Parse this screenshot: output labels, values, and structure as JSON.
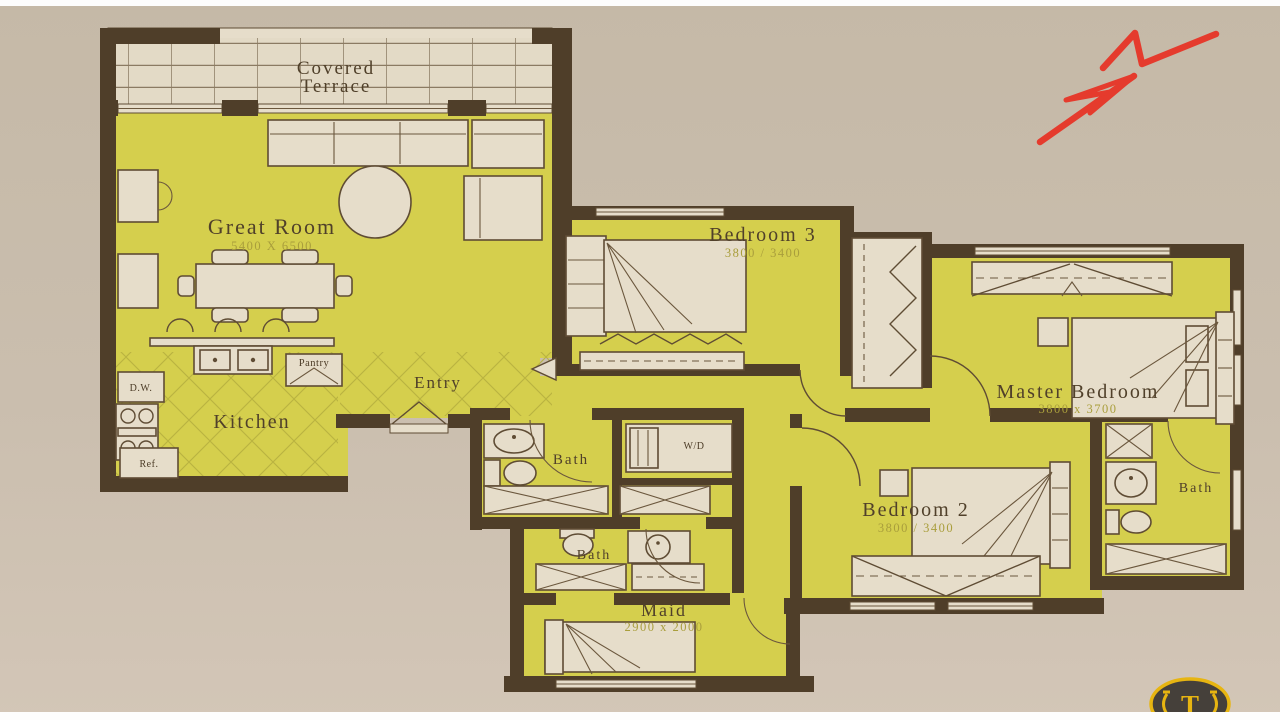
{
  "colors": {
    "paper": "#c8bcab",
    "paper_bottom": "#d2c5b6",
    "room_highlight": "#d5cf4d",
    "wall": "#4f3e29",
    "fixture_fill": "#e6ddca",
    "label_text": "#50402a",
    "dimension_text": "#a99e3c",
    "north_arrow_red": "#e53b2d",
    "logo_gold": "#e7b511",
    "logo_dark": "#45403a"
  },
  "rooms": {
    "terrace": {
      "label_line1": "Covered",
      "label_line2": "Terrace"
    },
    "great_room": {
      "label": "Great Room",
      "dims": "5400 X 6500"
    },
    "kitchen": {
      "label": "Kitchen"
    },
    "entry": {
      "label": "Entry"
    },
    "bedroom3": {
      "label": "Bedroom 3",
      "dims": "3800 / 3400"
    },
    "master_bedroom": {
      "label": "Master Bedroom",
      "dims": "3800 x 3700"
    },
    "bedroom2": {
      "label": "Bedroom 2",
      "dims": "3800 / 3400"
    },
    "maid": {
      "label": "Maid",
      "dims": "2900 x 2000"
    },
    "bath_hall": {
      "label": "Bath"
    },
    "bath_maid": {
      "label": "Bath"
    },
    "bath_master": {
      "label": "Bath"
    },
    "laundry_closet": {
      "label": "W/D"
    },
    "pantry": {
      "label": "Pantry"
    },
    "dishwasher": {
      "label": "D.W."
    },
    "refrigerator": {
      "label": "Ref."
    }
  },
  "annotations": {
    "north_marker": "N"
  },
  "logo": {
    "letter": "T"
  }
}
